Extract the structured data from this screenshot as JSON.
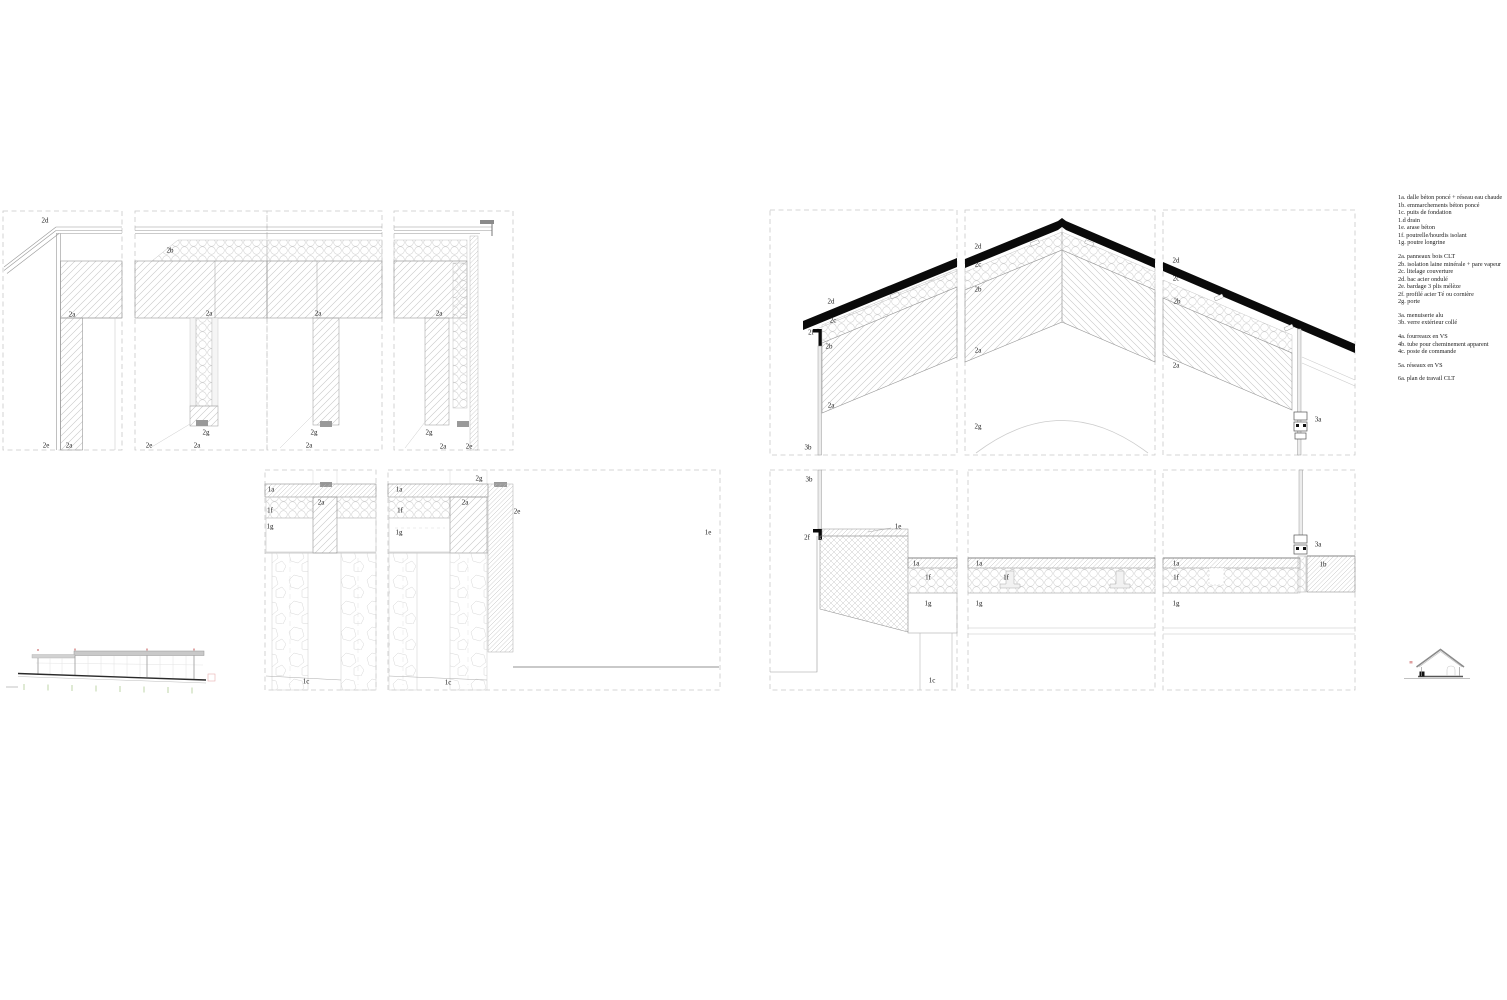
{
  "sheet": {
    "kind": "architectural construction detail sheet",
    "canvas": {
      "width": 1507,
      "height": 1000
    }
  },
  "colors": {
    "background": "#ffffff",
    "line_dark": "#0a0a0a",
    "line_mid": "#8f8f8f",
    "hatch": "#c6c6c6",
    "dashed_border": "#c9c9c9",
    "glazing_fill": "#ececec",
    "marker_gray": "#999999",
    "accent_red": "#dfa0a0",
    "accent_green": "#b8d2a0"
  },
  "legend": {
    "groups": [
      [
        "1a. dalle béton poncé + réseau eau chaude",
        "1b. emmarchements béton poncé",
        "1c. puits de fondation",
        "1.d drain",
        "1e. arase béton",
        "1f. poutrelle/hourdis isolant",
        "1g. poutre longrine"
      ],
      [
        "2a. panneaux bois CLT",
        "2b. isolation laine minérale + pare vapeur",
        "2c. litelage couverture",
        "2d. bac acier ondulé",
        "2e. bardage 3 plis mélèze",
        "2f. profilé acier Té ou cornière",
        "2g. porte"
      ],
      [
        "3a. menuiserie alu",
        "3b. verre extérieur collé"
      ],
      [
        "4a. fourreaux en VS",
        "4b. tube pour cheminement apparent",
        "4c. poste de commande"
      ],
      [
        "5a. réseaux en VS"
      ],
      [
        "6a. plan de travail CLT"
      ]
    ]
  },
  "annotations": [
    {
      "t": "2d",
      "x": 45,
      "y": 221
    },
    {
      "t": "2a",
      "x": 72,
      "y": 315
    },
    {
      "t": "2e",
      "x": 46,
      "y": 446
    },
    {
      "t": "2a",
      "x": 69,
      "y": 446
    },
    {
      "t": "2b",
      "x": 170,
      "y": 251
    },
    {
      "t": "2a",
      "x": 209,
      "y": 314
    },
    {
      "t": "2g",
      "x": 206,
      "y": 433
    },
    {
      "t": "2e",
      "x": 149,
      "y": 446
    },
    {
      "t": "2a",
      "x": 197,
      "y": 446
    },
    {
      "t": "2a",
      "x": 318,
      "y": 314
    },
    {
      "t": "2g",
      "x": 314,
      "y": 433
    },
    {
      "t": "2a",
      "x": 309,
      "y": 446
    },
    {
      "t": "2a",
      "x": 439,
      "y": 314
    },
    {
      "t": "2g",
      "x": 429,
      "y": 433
    },
    {
      "t": "2a",
      "x": 443,
      "y": 447
    },
    {
      "t": "2e",
      "x": 469,
      "y": 447
    },
    {
      "t": "1a",
      "x": 271,
      "y": 490
    },
    {
      "t": "2a",
      "x": 321,
      "y": 503
    },
    {
      "t": "1f",
      "x": 270,
      "y": 511
    },
    {
      "t": "1g",
      "x": 270,
      "y": 527
    },
    {
      "t": "1c",
      "x": 306,
      "y": 682
    },
    {
      "t": "2g",
      "x": 479,
      "y": 479
    },
    {
      "t": "1a",
      "x": 399,
      "y": 490
    },
    {
      "t": "2a",
      "x": 465,
      "y": 503
    },
    {
      "t": "1f",
      "x": 400,
      "y": 511
    },
    {
      "t": "1g",
      "x": 399,
      "y": 533
    },
    {
      "t": "2e",
      "x": 517,
      "y": 512
    },
    {
      "t": "1c",
      "x": 448,
      "y": 683
    },
    {
      "t": "1e",
      "x": 708,
      "y": 533
    },
    {
      "t": "2d",
      "x": 831,
      "y": 302
    },
    {
      "t": "2c",
      "x": 833,
      "y": 321
    },
    {
      "t": "2f",
      "x": 811,
      "y": 333
    },
    {
      "t": "2b",
      "x": 829,
      "y": 347
    },
    {
      "t": "2a",
      "x": 831,
      "y": 406
    },
    {
      "t": "3b",
      "x": 808,
      "y": 448
    },
    {
      "t": "2d",
      "x": 978,
      "y": 247
    },
    {
      "t": "2c",
      "x": 978,
      "y": 265
    },
    {
      "t": "2b",
      "x": 978,
      "y": 290
    },
    {
      "t": "2a",
      "x": 978,
      "y": 351
    },
    {
      "t": "2g",
      "x": 978,
      "y": 427
    },
    {
      "t": "2d",
      "x": 1176,
      "y": 261
    },
    {
      "t": "2c",
      "x": 1176,
      "y": 279
    },
    {
      "t": "2b",
      "x": 1177,
      "y": 302
    },
    {
      "t": "2a",
      "x": 1176,
      "y": 366
    },
    {
      "t": "3a",
      "x": 1318,
      "y": 420
    },
    {
      "t": "3b",
      "x": 809,
      "y": 480
    },
    {
      "t": "2f",
      "x": 807,
      "y": 538
    },
    {
      "t": "1e",
      "x": 898,
      "y": 527
    },
    {
      "t": "1a",
      "x": 916,
      "y": 564
    },
    {
      "t": "1f",
      "x": 928,
      "y": 578
    },
    {
      "t": "1g",
      "x": 928,
      "y": 604
    },
    {
      "t": "1c",
      "x": 932,
      "y": 681
    },
    {
      "t": "1a",
      "x": 979,
      "y": 564
    },
    {
      "t": "1f",
      "x": 1006,
      "y": 578
    },
    {
      "t": "1g",
      "x": 979,
      "y": 604
    },
    {
      "t": "1a",
      "x": 1176,
      "y": 564
    },
    {
      "t": "1f",
      "x": 1176,
      "y": 578
    },
    {
      "t": "3a",
      "x": 1318,
      "y": 545
    },
    {
      "t": "1b",
      "x": 1323,
      "y": 565
    },
    {
      "t": "1g",
      "x": 1176,
      "y": 604
    }
  ]
}
